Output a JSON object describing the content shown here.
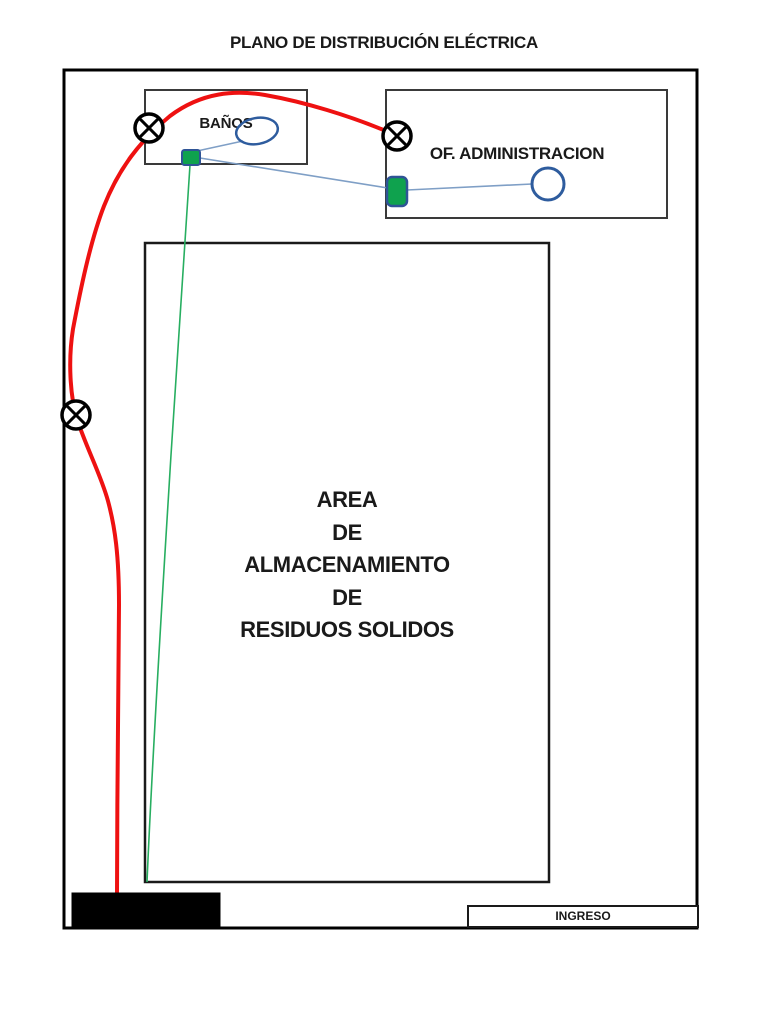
{
  "title": "PLANO DE DISTRIBUCIÓN ELÉCTRICA",
  "rooms": {
    "banos": {
      "label": "BAÑOS"
    },
    "administracion": {
      "label": "OF. ADMINISTRACION"
    },
    "almacenamiento": {
      "lines": [
        "AREA",
        "DE",
        "ALMACENAMIENTO",
        "DE",
        "RESIDUOS SOLIDOS"
      ]
    },
    "ingreso": {
      "label": "INGRESO"
    }
  },
  "symbols": {
    "lamp_count": 3,
    "switch_count": 2,
    "luminaire_count": 2,
    "icons": {
      "ceiling-lamp": "circle-with-x",
      "switch": "green-rounded-square",
      "luminaire": "blue-circle",
      "main-panel": "black-rectangle"
    }
  },
  "colors": {
    "power_cable": "#ee1111",
    "switch_cable": "#27ae60",
    "light_cable": "#7f9fc6",
    "switch_fill": "#0fa24e",
    "fixture_stroke": "#2e5c9e",
    "wall": "#000000",
    "room_stroke": "#3a3a3a"
  }
}
